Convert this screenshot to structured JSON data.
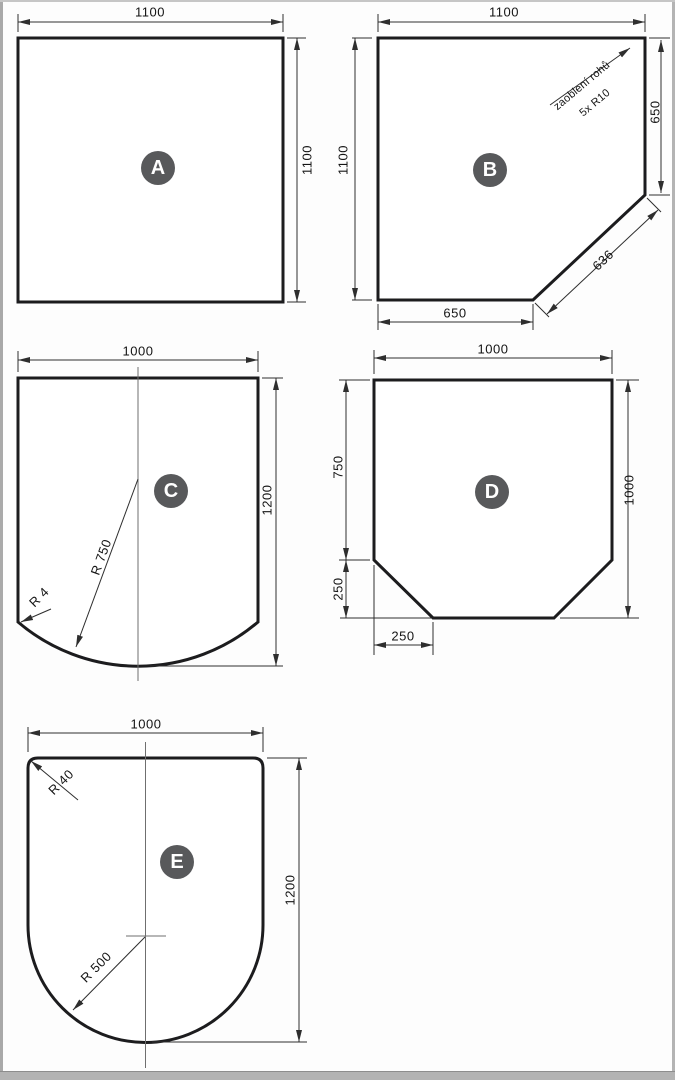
{
  "drawing": {
    "title": "floor-plate-shapes-technical-drawing",
    "colors": {
      "background": "#fdfdfd",
      "outline": "#1c1c1e",
      "dimension_line": "#2e2e2e",
      "centerline": "#6f6f6f",
      "badge_background": "#58595b",
      "badge_text": "#ffffff",
      "edge_gray": "#b3b3b3"
    },
    "shapes": {
      "a": {
        "label": "A",
        "width": "1100",
        "height": "1100"
      },
      "b": {
        "label": "B",
        "width": "1100",
        "height": "1100",
        "right": "650",
        "diagonal": "636",
        "bottom": "650",
        "note_line1": "zaoblení rohů",
        "note_line2": "5x R10"
      },
      "c": {
        "label": "C",
        "width": "1000",
        "height": "1200",
        "radius": "R 750",
        "corner_radius": "R 4"
      },
      "d": {
        "label": "D",
        "width": "1000",
        "height": "1000",
        "left_upper": "750",
        "left_lower": "250",
        "bottom_cut": "250"
      },
      "e": {
        "label": "E",
        "width": "1000",
        "height": "1200",
        "radius": "R 500",
        "corner_radius": "R 40"
      }
    }
  }
}
